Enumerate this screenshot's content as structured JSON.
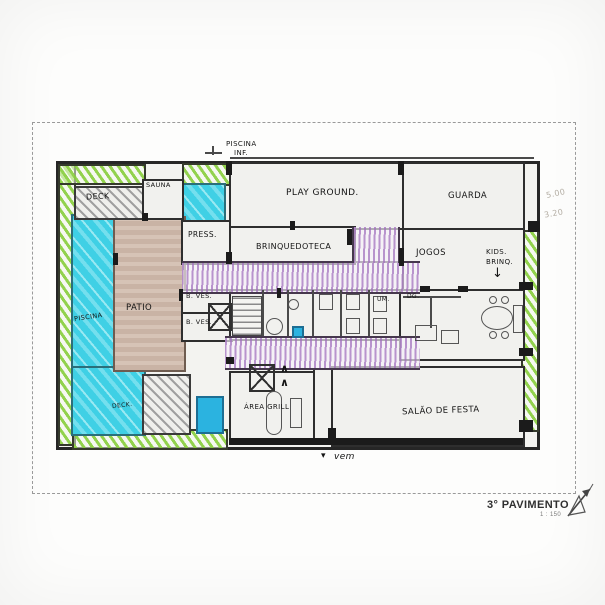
{
  "sheet": {
    "title": "3° PAVIMENTO",
    "scale": "1 : 150"
  },
  "rooms": {
    "deck": "DECK",
    "sauna": "SAUNA",
    "piscina": "PISCINA",
    "patio": "PATIO",
    "press": "PRESS.",
    "playground": "PLAY GROUND.",
    "brinquedoteca": "BRINQUEDOTECA",
    "guarda": "GUARDA",
    "jogos": "JOGOS",
    "kids_line1": "KIDS.",
    "kids_line2": "BRINQ.",
    "bves1": "B. VES.",
    "bves2": "B. VES.",
    "um": "UM.",
    "dg": "DG.",
    "deck_small": "DECK.",
    "area_grill": "ÁREA GRILL",
    "salao": "SALÃO DE FESTA"
  },
  "annotations": {
    "piscina_inf_line1": "PISCINA",
    "piscina_inf_line2": "INF.",
    "entry_arrow": "▾",
    "entry": "vem",
    "kids_arrow": "↓",
    "pencil_dim1": "5.00",
    "pencil_dim2": "3.20"
  },
  "colors": {
    "pool_cyan": "#3fd0e5",
    "accent_blue": "#2bb3e0",
    "hatch_green": "#8dd044",
    "hatch_purple": "#b289c9",
    "patio_tan": "#c9b3a5",
    "ink": "#262626"
  }
}
